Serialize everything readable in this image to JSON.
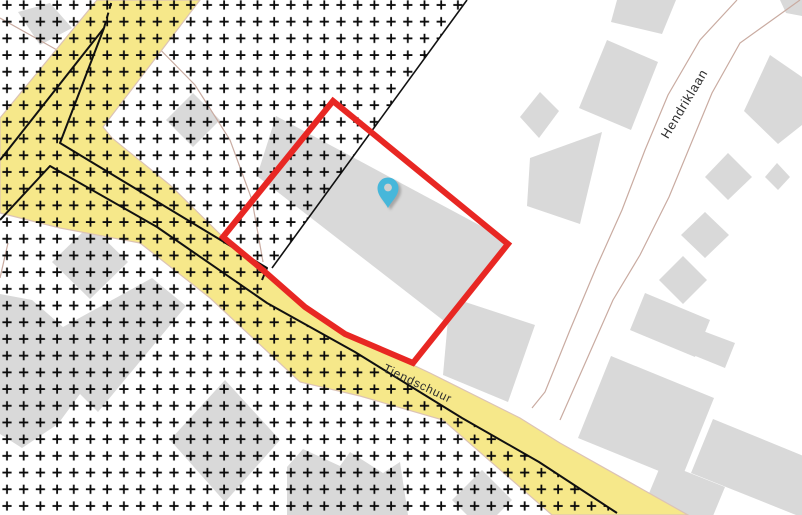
{
  "map": {
    "type": "cadastral-map-viewer",
    "streets": [
      {
        "name": "Tiendschuur"
      },
      {
        "name": "Hendriklaan"
      }
    ],
    "marker": {
      "kind": "location-pin",
      "status": "selected"
    },
    "parcel": {
      "status": "highlighted"
    },
    "overlays": [
      {
        "name": "plus-hatch-zone",
        "style": "black plus-sign hatch"
      }
    ]
  },
  "theme": {
    "background": "#ffffff",
    "building_fill": "#d9d9d9",
    "road_fill": "#f6e88a",
    "road_casing": "#dcc3b6",
    "minor_road_casing": "#c9aba1",
    "boundary_line": "#111111",
    "hatch_color": "#0a0a0a",
    "parcel_outline": "#e82723",
    "marker_fill": "#47b7da",
    "marker_hole": "#cfcfcf",
    "label_color": "#2e2e2e"
  }
}
